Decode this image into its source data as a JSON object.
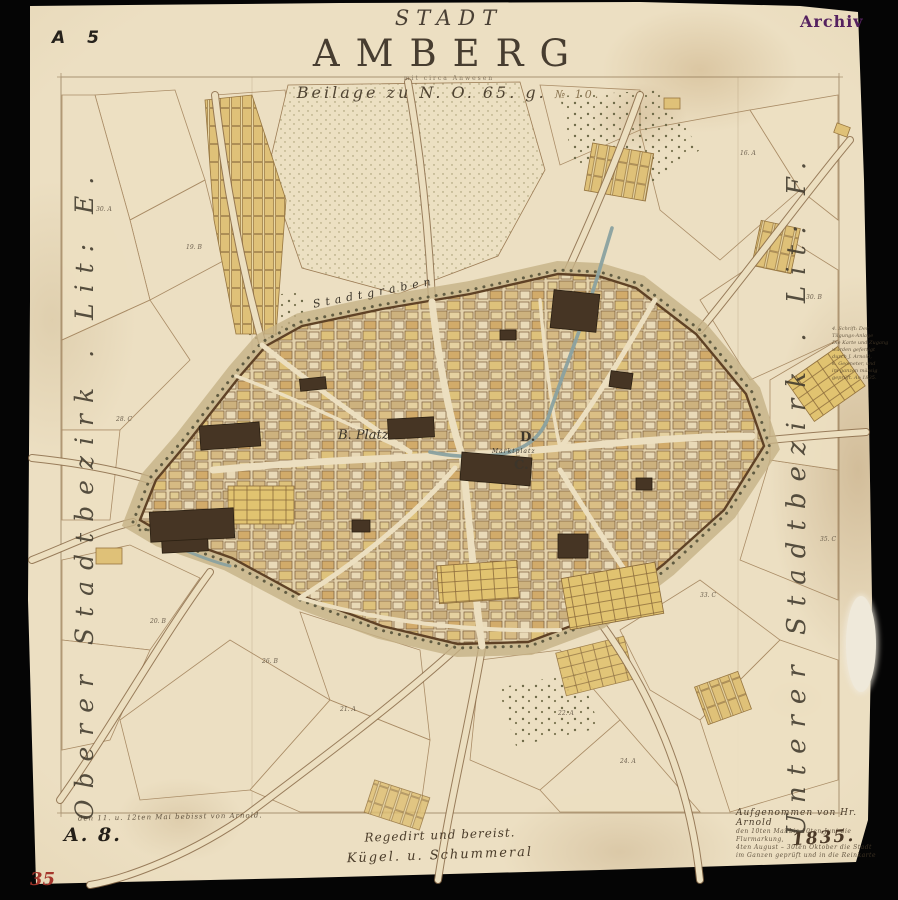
{
  "stamps": {
    "sheet_ref": "A 5",
    "archiv": "Archiv",
    "inventory": "A. 8.",
    "red_number": "35"
  },
  "title": {
    "kicker": "STADT",
    "main": "AMBERG",
    "sub_small": "mit circa Anwesen",
    "reference": "Beilage zu N. O. 65. g.",
    "reference_suffix": "№ 10."
  },
  "margins": {
    "left": "Oberer Stadtbezirk . Lit: E.",
    "right": "Unterer Stadtbezirk . Lit: F."
  },
  "map_labels": {
    "moat": "Stadtgraben",
    "square_b": "B. Platz",
    "letter_c": "C.",
    "letter_d": "D.",
    "market": "Marktplatz"
  },
  "footer": {
    "note_left": "den 11. u. 12ten Mai bebisst von Arnold.",
    "signature_line1": "Regedirt und bereist.",
    "signature_line2": "Kügel.      u. Schummeral",
    "survey_title": "Aufgenommen von Hr. Arnold",
    "survey_lines": [
      "den 10ten Mai bis 10ten Juni die Flurmarkung,",
      "4ten August – 30ten Oktober die Stadt",
      "im Ganzen geprüft und in die Reinkarte"
    ],
    "year": "1835."
  },
  "side_note": {
    "lines": [
      "4. Schrift: Der",
      "Tilgungs-Anlage",
      "Die Karte und Zugang",
      "wurden gefertigt",
      "durch J. Arnold,",
      "k. Geometer, und",
      "im ganzen mässig",
      "geprüft. Ao 1835."
    ]
  },
  "map_marks": [
    {
      "t": "30. A",
      "x": 96,
      "y": 206
    },
    {
      "t": "19. B",
      "x": 186,
      "y": 244
    },
    {
      "t": "28. C",
      "x": 116,
      "y": 416
    },
    {
      "t": "20. B",
      "x": 150,
      "y": 618
    },
    {
      "t": "26. B",
      "x": 262,
      "y": 658
    },
    {
      "t": "21. A",
      "x": 340,
      "y": 706
    },
    {
      "t": "22. A",
      "x": 558,
      "y": 710
    },
    {
      "t": "24. A",
      "x": 620,
      "y": 758
    },
    {
      "t": "33. C",
      "x": 700,
      "y": 592
    },
    {
      "t": "35. C",
      "x": 820,
      "y": 536
    },
    {
      "t": "30. B",
      "x": 806,
      "y": 294
    },
    {
      "t": "16. A",
      "x": 740,
      "y": 150
    }
  ]
}
